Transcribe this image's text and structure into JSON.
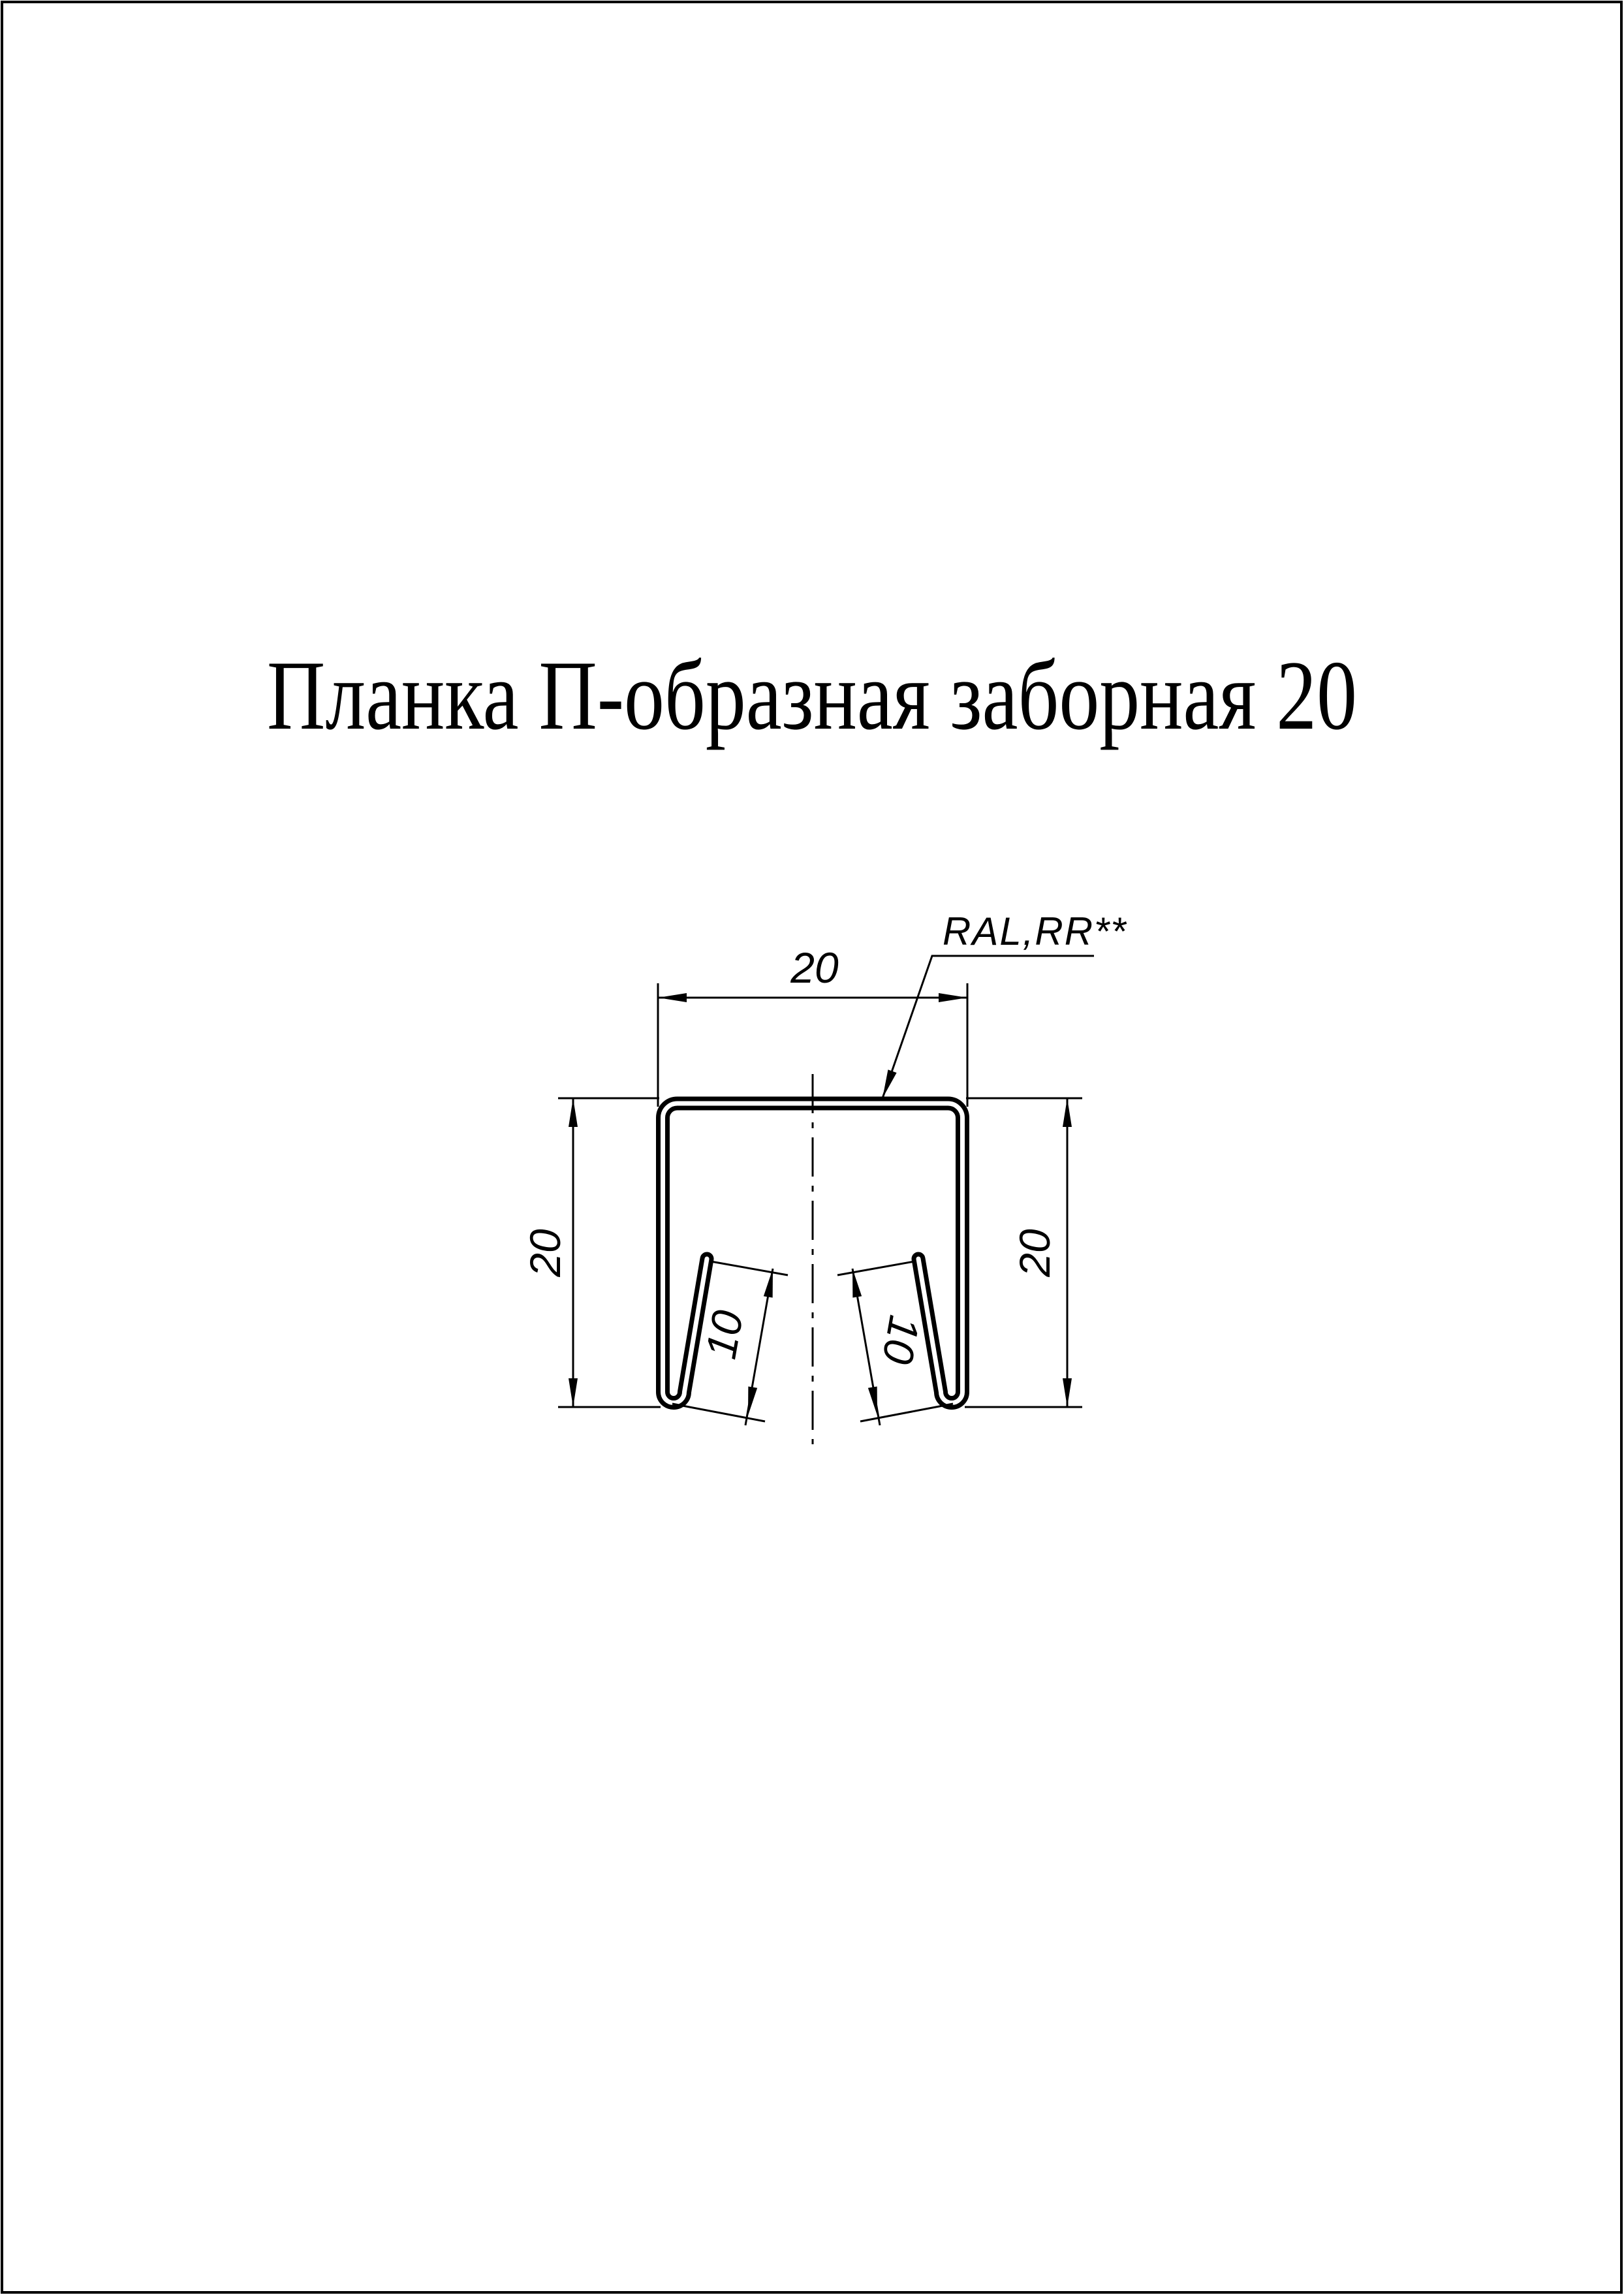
{
  "page": {
    "background_color": "#ffffff",
    "line_color": "#000000",
    "border_color": "#000000"
  },
  "title": {
    "text": "Планка П-образная заборная 20"
  },
  "drawing": {
    "type": "cross-section of U-shaped fence strip profile",
    "coating_label": "RAL,RR**",
    "dim_width_top": "20",
    "dim_height_left": "20",
    "dim_height_right": "20",
    "dim_flange_left": "10",
    "dim_flange_right": "10"
  }
}
